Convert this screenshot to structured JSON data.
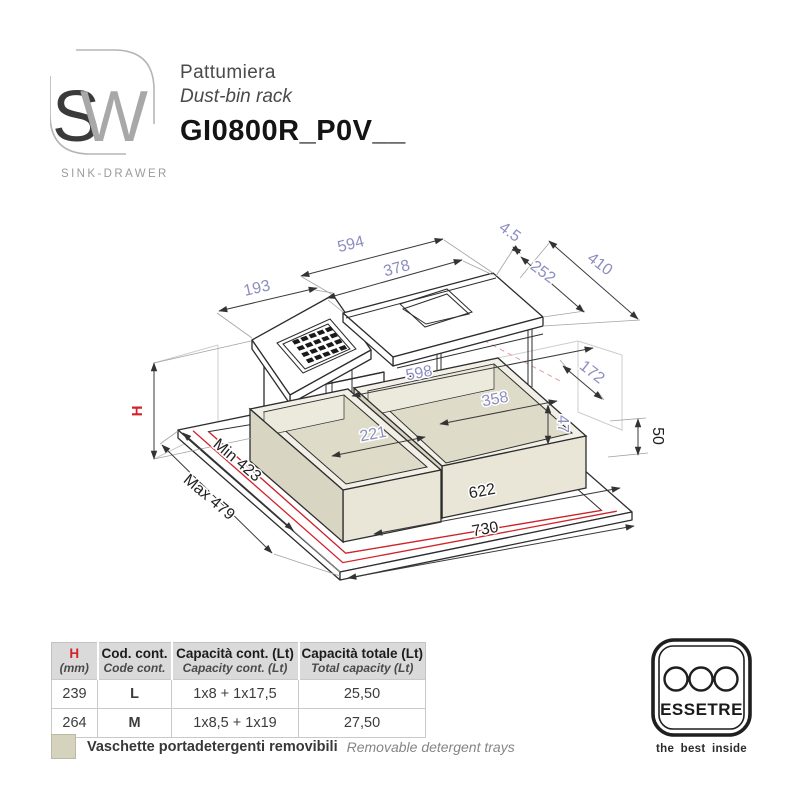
{
  "logo": {
    "letter_s": "S",
    "letter_w": "W",
    "caption": "SINK-DRAWER"
  },
  "header": {
    "title_it": "Pattumiera",
    "title_en": "Dust-bin rack",
    "code": "GI0800R_P0V__"
  },
  "drawing": {
    "colors": {
      "dim_label": "#8d8dc0",
      "accent_red": "#d2232a",
      "tray_fill": "#e9e6d8"
    },
    "dims": {
      "top_width": "594",
      "lid_width": "378",
      "small_lid_width": "193",
      "back_lip": "4.5",
      "lid_depth": "252",
      "top_depth": "410",
      "side_depth": "172",
      "frame_height": "50",
      "height": "H",
      "min_depth": "Min 423",
      "max_depth": "Max 479",
      "inner_span": "622",
      "total_width": "730",
      "inner_width": "598",
      "tray_large": "358",
      "tray_small": "221",
      "tray_rim": "47"
    }
  },
  "table": {
    "headers": [
      {
        "line1": "H",
        "line2": "(mm)"
      },
      {
        "line1": "Cod. cont.",
        "line2": "Code cont."
      },
      {
        "line1": "Capacità cont. (Lt)",
        "line2": "Capacity cont. (Lt)"
      },
      {
        "line1": "Capacità totale (Lt)",
        "line2": "Total capacity (Lt)"
      }
    ],
    "rows": [
      [
        "239",
        "L",
        "1x8 + 1x17,5",
        "25,50"
      ],
      [
        "264",
        "M",
        "1x8,5 + 1x19",
        "27,50"
      ]
    ]
  },
  "legend": {
    "it": "Vaschette portadetergenti removibili",
    "en": "Removable detergent trays"
  },
  "brand": {
    "name": "ESSETRE",
    "tagline": "the best inside"
  }
}
